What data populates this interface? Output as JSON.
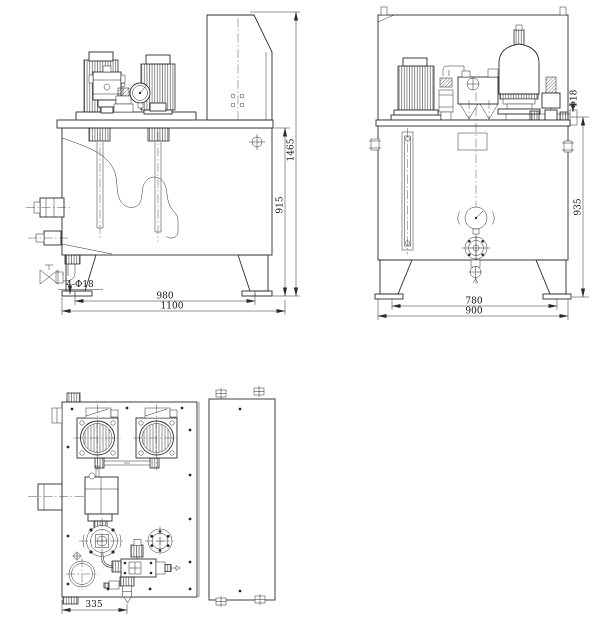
{
  "page": {
    "background": "#ffffff"
  },
  "drawing": {
    "kind": "hydraulic-power-unit-three-view-engineering-drawing",
    "stroke_color": "#2b2b2b",
    "views": {
      "front": {
        "name": "front-view",
        "dims": {
          "overall_height": "1465",
          "tank_height": "915",
          "foot_spacing": "980",
          "overall_width": "1100",
          "mount_holes": "4-Φ18"
        }
      },
      "side": {
        "name": "side-view",
        "dims": {
          "port_height": "935",
          "foot_spacing": "780",
          "overall_depth": "900",
          "port_diameter": "Φ18"
        }
      },
      "top": {
        "name": "top-view",
        "dims": {
          "drain_offset": "335"
        }
      }
    }
  }
}
